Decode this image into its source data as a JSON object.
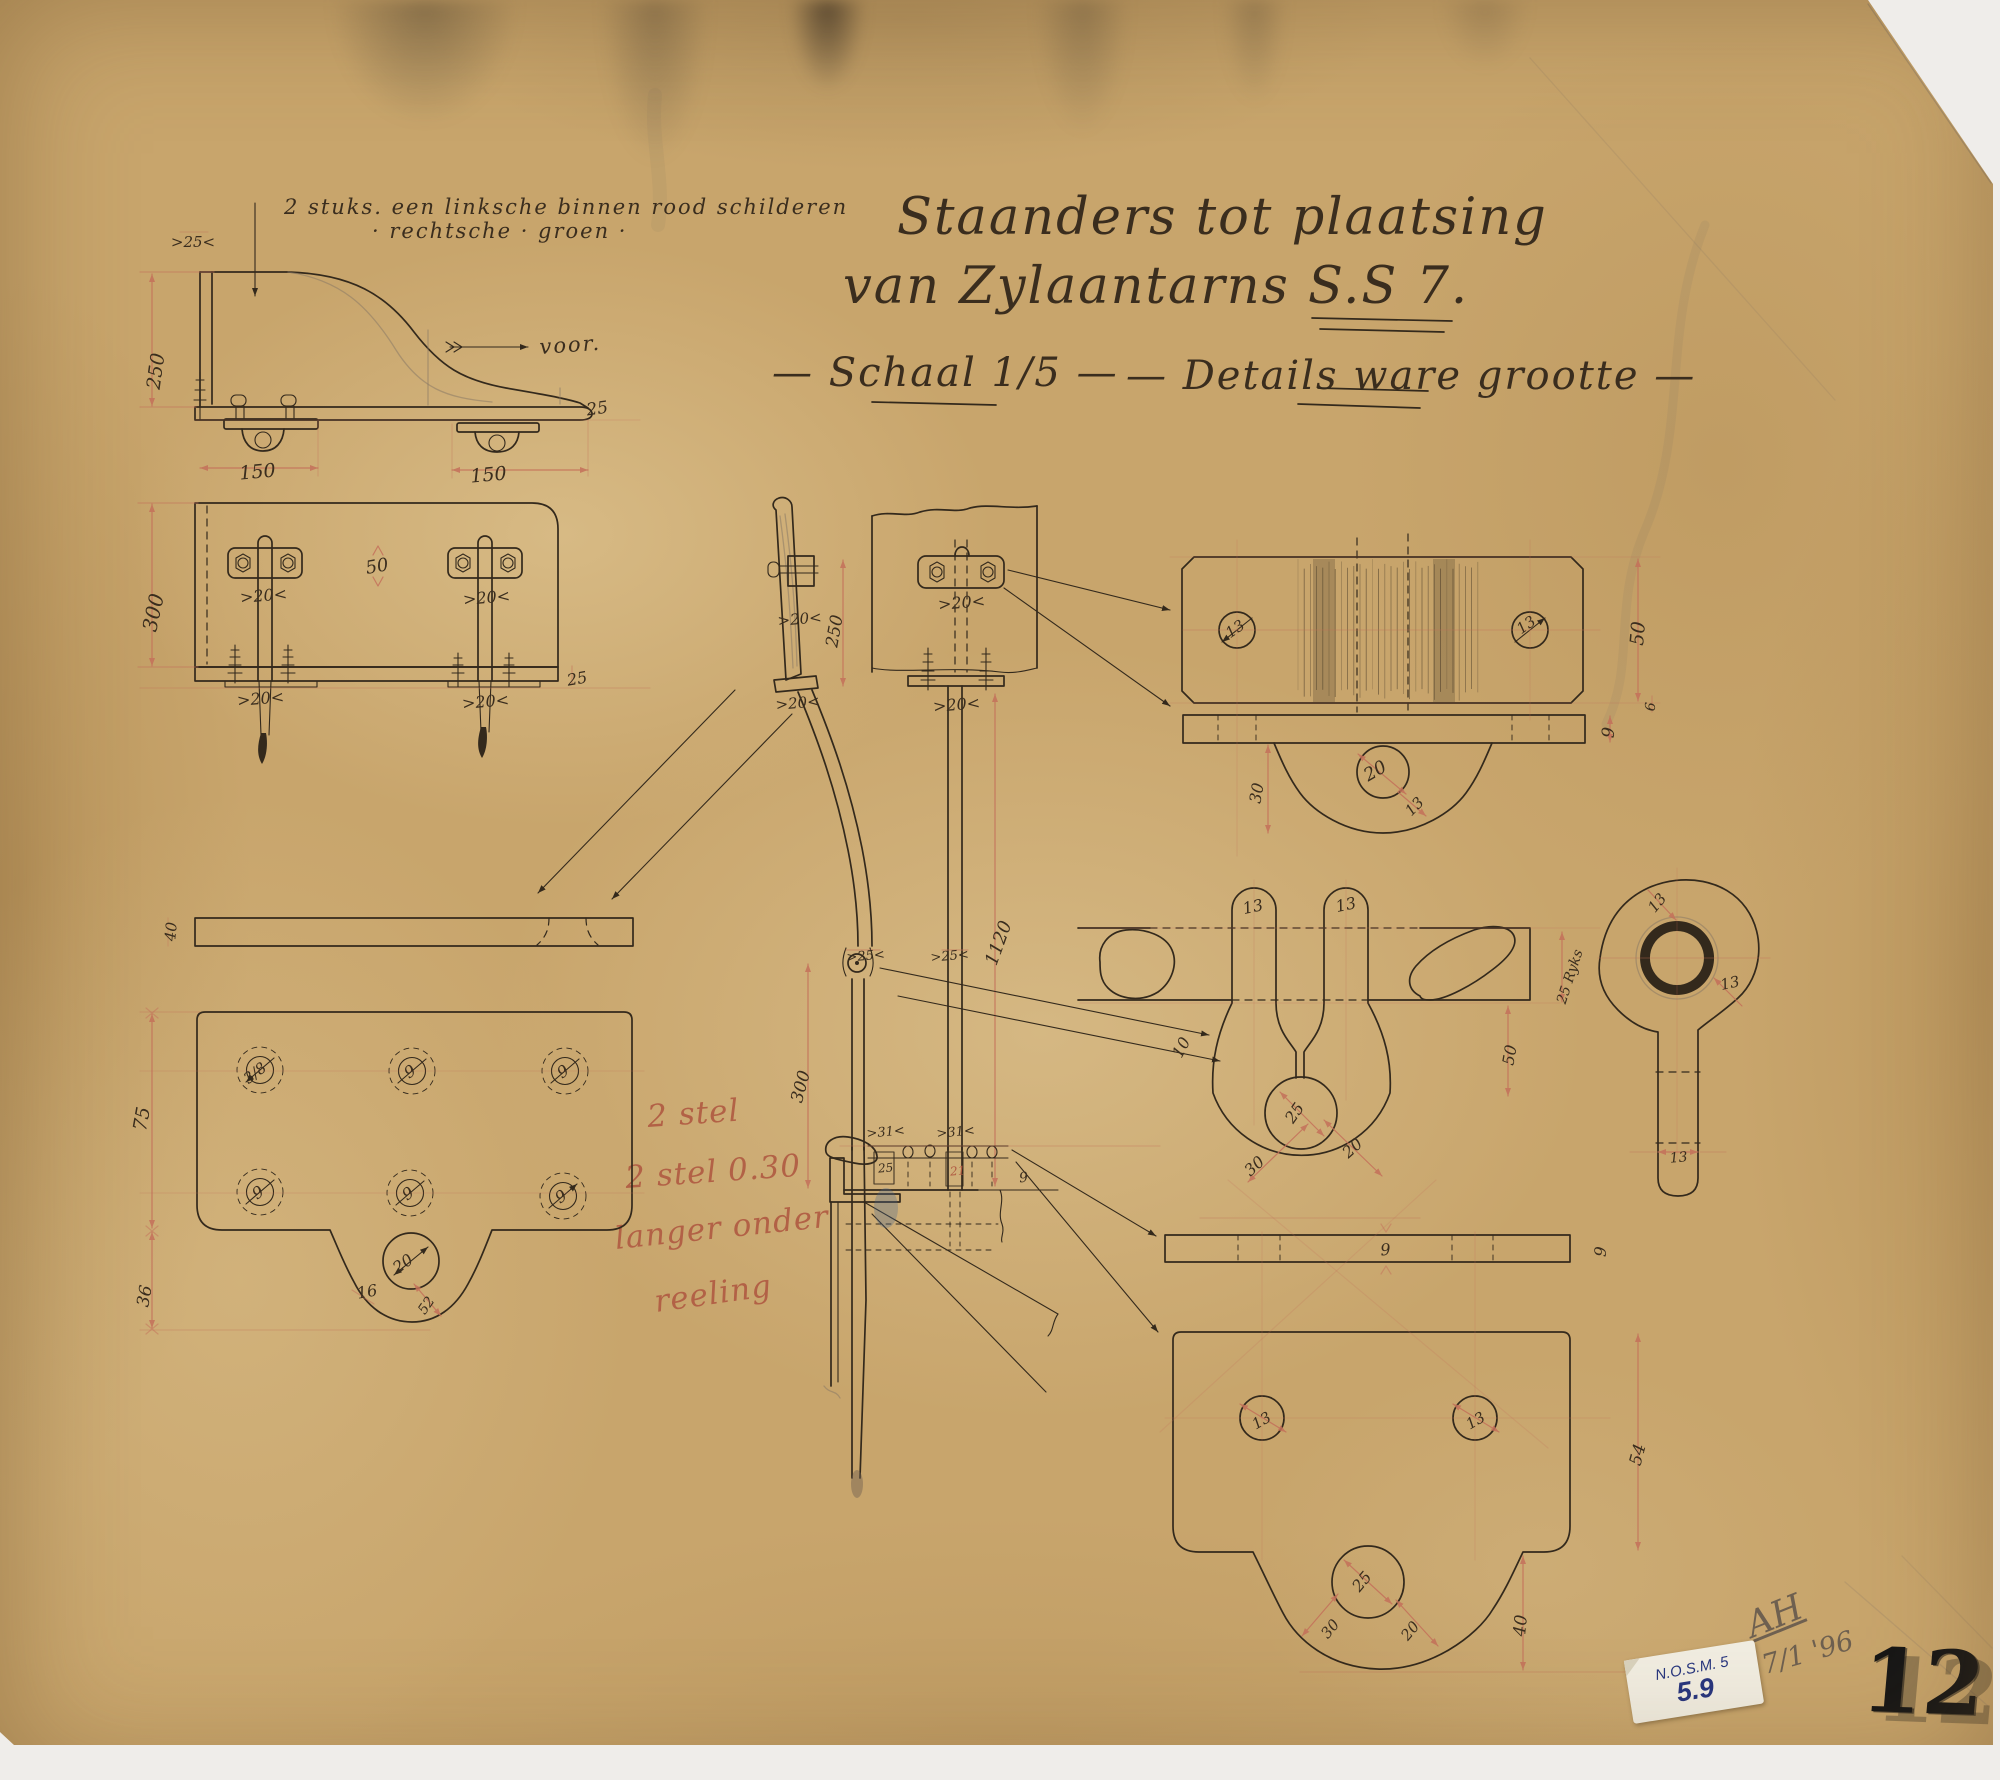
{
  "document": {
    "title_line1": "Staanders tot plaatsing",
    "title_line2": "van Zylaantarns S.S 7.",
    "subtitle_scale": "— Schaal 1/5 —",
    "subtitle_details": "— Details ware grootte —",
    "note_line1": "2 stuks. een linksche binnen rood schilderen",
    "note_line2": "·   rechtsche   ·   groen   ·",
    "direction_label": "voor.",
    "red_note_lines": [
      "2 stel",
      "2 stel 0.30",
      "langer onder",
      "reeling"
    ]
  },
  "annotations": {
    "signature": "AH",
    "date": "17/1 '96",
    "sticker_line1": "N.O.S.M. 5",
    "sticker_line2": "5.9",
    "sheet_number": "12"
  },
  "colors": {
    "paper": "#c8a56c",
    "ink": "#33291c",
    "ink_text": "#3a2d1e",
    "red_line": "#c4705a",
    "red_text": "#b05a42",
    "blue_fitting": "#4a6f9c",
    "red_fitting": "#c05540",
    "pencil": "#8a7a66",
    "sticker_ink": "#27357e"
  },
  "dimension_labels": [
    {
      "t": ">25<",
      "x": 193,
      "y": 247,
      "r": 0,
      "s": 15
    },
    {
      "t": "250",
      "x": 162,
      "y": 372,
      "r": -82,
      "s": 19
    },
    {
      "t": "25",
      "x": 598,
      "y": 414,
      "r": -8,
      "s": 17
    },
    {
      "t": "150",
      "x": 258,
      "y": 478,
      "r": -5,
      "s": 19
    },
    {
      "t": "150",
      "x": 489,
      "y": 481,
      "r": -5,
      "s": 19
    },
    {
      "t": "300",
      "x": 160,
      "y": 614,
      "r": -78,
      "s": 20
    },
    {
      "t": "50",
      "x": 378,
      "y": 572,
      "r": -10,
      "s": 18
    },
    {
      "t": ">20<",
      "x": 264,
      "y": 601,
      "r": -5,
      "s": 16
    },
    {
      "t": ">20<",
      "x": 487,
      "y": 603,
      "r": -5,
      "s": 16
    },
    {
      "t": ">20<",
      "x": 261,
      "y": 704,
      "r": -5,
      "s": 16
    },
    {
      "t": ">20<",
      "x": 486,
      "y": 707,
      "r": -5,
      "s": 16
    },
    {
      "t": "25",
      "x": 578,
      "y": 684,
      "r": -10,
      "s": 16
    },
    {
      "t": ">20<",
      "x": 800,
      "y": 624,
      "r": -5,
      "s": 15
    },
    {
      "t": "250",
      "x": 840,
      "y": 632,
      "r": -80,
      "s": 17
    },
    {
      "t": ">20<",
      "x": 962,
      "y": 608,
      "r": -5,
      "s": 16
    },
    {
      "t": ">20<",
      "x": 798,
      "y": 708,
      "r": -5,
      "s": 15
    },
    {
      "t": ">20<",
      "x": 957,
      "y": 710,
      "r": -5,
      "s": 16
    },
    {
      "t": ">25<",
      "x": 866,
      "y": 960,
      "r": -5,
      "s": 13
    },
    {
      "t": ">25<",
      "x": 950,
      "y": 960,
      "r": -5,
      "s": 13
    },
    {
      "t": "1120",
      "x": 1004,
      "y": 945,
      "r": -70,
      "s": 18
    },
    {
      "t": "300",
      "x": 806,
      "y": 1088,
      "r": -75,
      "s": 17
    },
    {
      "t": ">31<",
      "x": 886,
      "y": 1136,
      "r": -5,
      "s": 13
    },
    {
      "t": ">31<",
      "x": 956,
      "y": 1136,
      "r": -5,
      "s": 13
    },
    {
      "t": "25",
      "x": 886,
      "y": 1172,
      "r": -5,
      "s": 12
    },
    {
      "t": "21",
      "x": 958,
      "y": 1175,
      "r": -5,
      "s": 12,
      "k": "redlbl"
    },
    {
      "t": "9",
      "x": 1024,
      "y": 1182,
      "r": -5,
      "s": 14
    },
    {
      "t": "40",
      "x": 176,
      "y": 932,
      "r": -85,
      "s": 15
    },
    {
      "t": "75",
      "x": 148,
      "y": 1120,
      "r": -80,
      "s": 19
    },
    {
      "t": "36",
      "x": 150,
      "y": 1297,
      "r": -80,
      "s": 17
    },
    {
      "t": "3/8",
      "x": 258,
      "y": 1077,
      "r": -38,
      "s": 15
    },
    {
      "t": "9",
      "x": 413,
      "y": 1076,
      "r": -35,
      "s": 16
    },
    {
      "t": "9",
      "x": 566,
      "y": 1076,
      "r": -35,
      "s": 16
    },
    {
      "t": "9",
      "x": 261,
      "y": 1197,
      "r": -35,
      "s": 16
    },
    {
      "t": "9",
      "x": 411,
      "y": 1198,
      "r": -35,
      "s": 16
    },
    {
      "t": "9",
      "x": 564,
      "y": 1201,
      "r": -35,
      "s": 16
    },
    {
      "t": "20",
      "x": 406,
      "y": 1268,
      "r": -35,
      "s": 16
    },
    {
      "t": "16",
      "x": 368,
      "y": 1297,
      "r": -10,
      "s": 16
    },
    {
      "t": "52",
      "x": 430,
      "y": 1308,
      "r": -55,
      "s": 14
    },
    {
      "t": "13",
      "x": 1238,
      "y": 633,
      "r": -35,
      "s": 15
    },
    {
      "t": "13",
      "x": 1529,
      "y": 629,
      "r": -35,
      "s": 15
    },
    {
      "t": "50",
      "x": 1644,
      "y": 634,
      "r": -85,
      "s": 19
    },
    {
      "t": "9",
      "x": 1614,
      "y": 733,
      "r": -85,
      "s": 17
    },
    {
      "t": "6",
      "x": 1655,
      "y": 707,
      "r": -85,
      "s": 14
    },
    {
      "t": "30",
      "x": 1262,
      "y": 794,
      "r": -80,
      "s": 16
    },
    {
      "t": "20",
      "x": 1378,
      "y": 776,
      "r": -30,
      "s": 18
    },
    {
      "t": "13",
      "x": 1418,
      "y": 810,
      "r": -45,
      "s": 15
    },
    {
      "t": "13",
      "x": 1254,
      "y": 912,
      "r": -12,
      "s": 16
    },
    {
      "t": "13",
      "x": 1347,
      "y": 910,
      "r": -12,
      "s": 16
    },
    {
      "t": "10",
      "x": 1186,
      "y": 1050,
      "r": -62,
      "s": 16
    },
    {
      "t": "25",
      "x": 1299,
      "y": 1116,
      "r": -55,
      "s": 16
    },
    {
      "t": "30",
      "x": 1258,
      "y": 1170,
      "r": -42,
      "s": 16
    },
    {
      "t": "20",
      "x": 1356,
      "y": 1152,
      "r": -42,
      "s": 16
    },
    {
      "t": "50",
      "x": 1515,
      "y": 1056,
      "r": -80,
      "s": 16
    },
    {
      "t": "25 Ryks",
      "x": 1574,
      "y": 978,
      "r": -72,
      "s": 14
    },
    {
      "t": "13",
      "x": 1661,
      "y": 906,
      "r": -50,
      "s": 15
    },
    {
      "t": "13",
      "x": 1731,
      "y": 988,
      "r": -12,
      "s": 15
    },
    {
      "t": "13",
      "x": 1679,
      "y": 1162,
      "r": -5,
      "s": 14
    },
    {
      "t": "9",
      "x": 1386,
      "y": 1255,
      "r": -5,
      "s": 16
    },
    {
      "t": "9",
      "x": 1606,
      "y": 1252,
      "r": -85,
      "s": 16
    },
    {
      "t": "13",
      "x": 1264,
      "y": 1425,
      "r": -30,
      "s": 15
    },
    {
      "t": "13",
      "x": 1478,
      "y": 1425,
      "r": -30,
      "s": 15
    },
    {
      "t": "54",
      "x": 1643,
      "y": 1456,
      "r": -75,
      "s": 17
    },
    {
      "t": "25",
      "x": 1366,
      "y": 1585,
      "r": -50,
      "s": 16
    },
    {
      "t": "30",
      "x": 1334,
      "y": 1632,
      "r": -50,
      "s": 15
    },
    {
      "t": "20",
      "x": 1414,
      "y": 1634,
      "r": -50,
      "s": 15
    },
    {
      "t": "40",
      "x": 1526,
      "y": 1626,
      "r": -85,
      "s": 17
    }
  ]
}
